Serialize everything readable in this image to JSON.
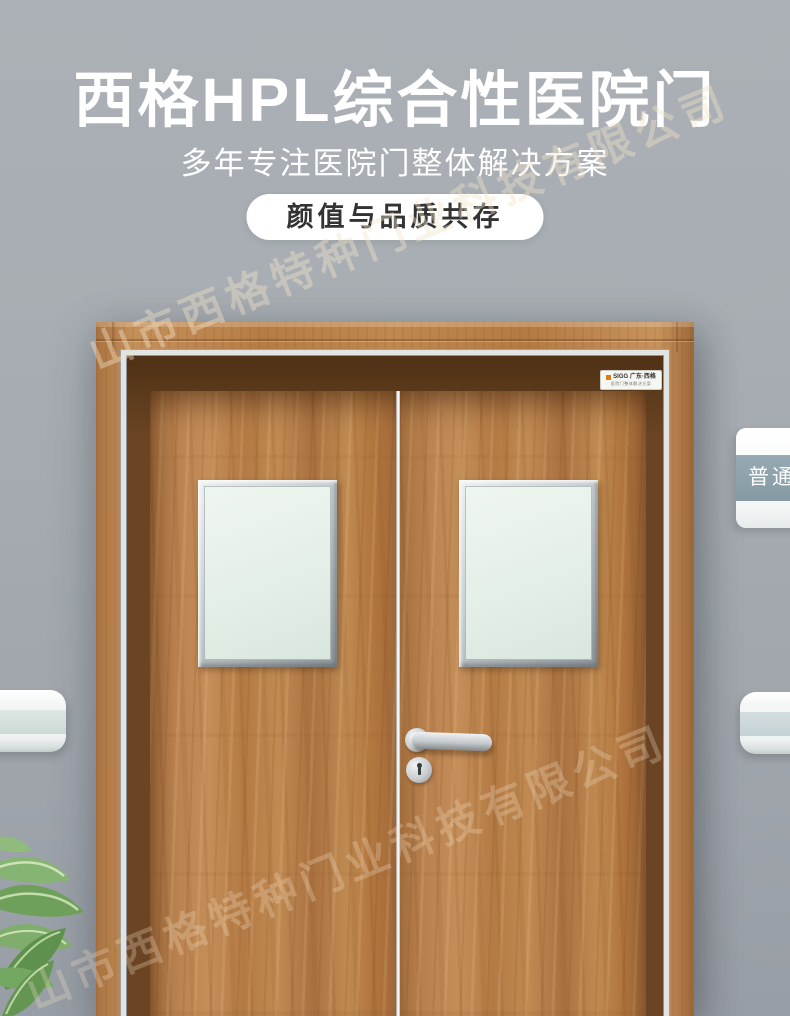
{
  "meta": {
    "canvas_width": 790,
    "canvas_height": 1016
  },
  "header": {
    "title": "西格HPL综合性医院门",
    "subtitle": "多年专注医院门整体解决方案",
    "badge_label": "颜值与品质共存"
  },
  "watermark": {
    "line1": "山市西格特种门业科技有限公司",
    "line2": "山市西格特种门业科技有限公司"
  },
  "door": {
    "brand_plate": {
      "line1": "SIGG 广东·西格",
      "line2": "医院门整体解决方案"
    }
  },
  "room_sign": {
    "label": "普通"
  },
  "colors": {
    "wall": "#a7adb2",
    "wood_mid": "#b97f4a",
    "wood_reveal_dark": "#5e3c1f",
    "trim_silver": "#e2e4e4",
    "glass": "#e7f1ea",
    "badge_bg": "#ffffff",
    "badge_text": "#333333",
    "title_text": "#ffffff",
    "sign_band": "#8ea3ad",
    "rail_band": "#d4e2dd",
    "brand_accent_orange": "#e07b18",
    "watermark_tint": "rgba(240,226,200,0.42)"
  }
}
